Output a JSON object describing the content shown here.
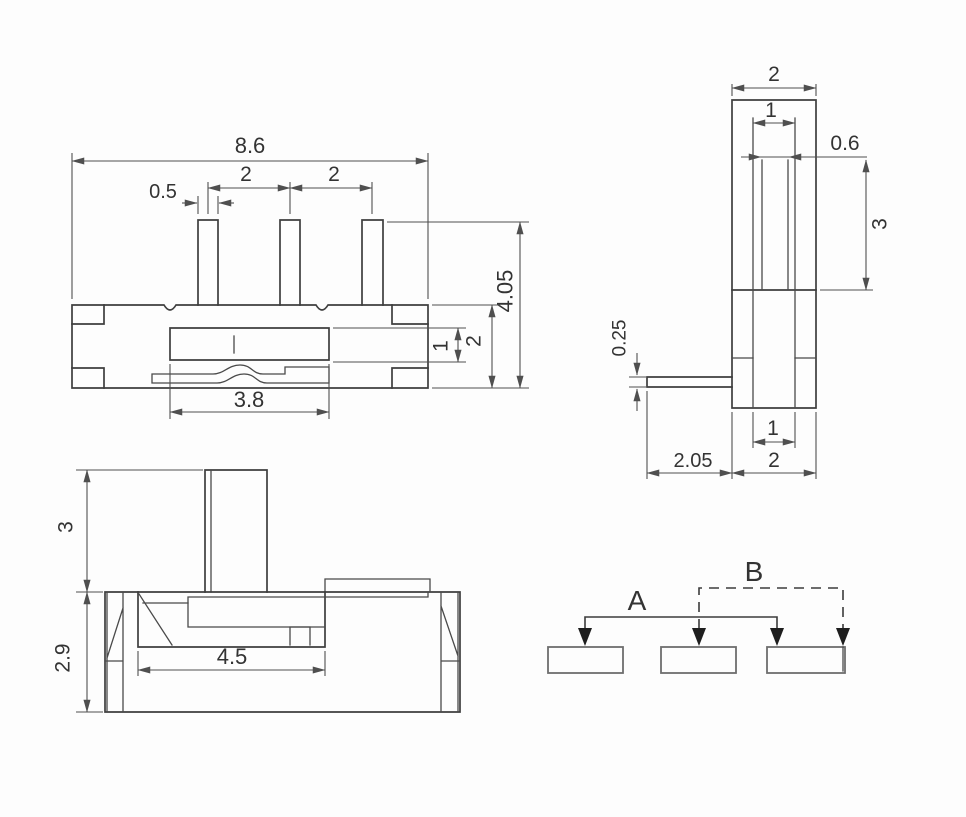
{
  "colors": {
    "background": "#fdfdfd",
    "outline": "#3e3e3e",
    "dimension": "#4f4f4f",
    "text": "#333333",
    "arrow_fill": "#1e1e1e"
  },
  "front_view": {
    "dims": {
      "overall_width": "8.6",
      "pin_width": "0.5",
      "pin_pitch_left": "2",
      "pin_pitch_right": "2",
      "total_height": "4.05",
      "slot_height": "1",
      "body_height": "2",
      "slot_width": "3.8"
    }
  },
  "side_view": {
    "dims": {
      "top_width": "2",
      "stem_width": "1",
      "slot_width": "0.6",
      "knob_height": "3",
      "pin_thickness": "0.25",
      "pin_length": "2.05",
      "base_slot_width": "1",
      "base_width": "2"
    }
  },
  "top_view": {
    "dims": {
      "knob_height": "3",
      "body_depth": "2.9",
      "opening_width": "4.5"
    }
  },
  "schematic": {
    "position_a": "A",
    "position_b": "B"
  }
}
